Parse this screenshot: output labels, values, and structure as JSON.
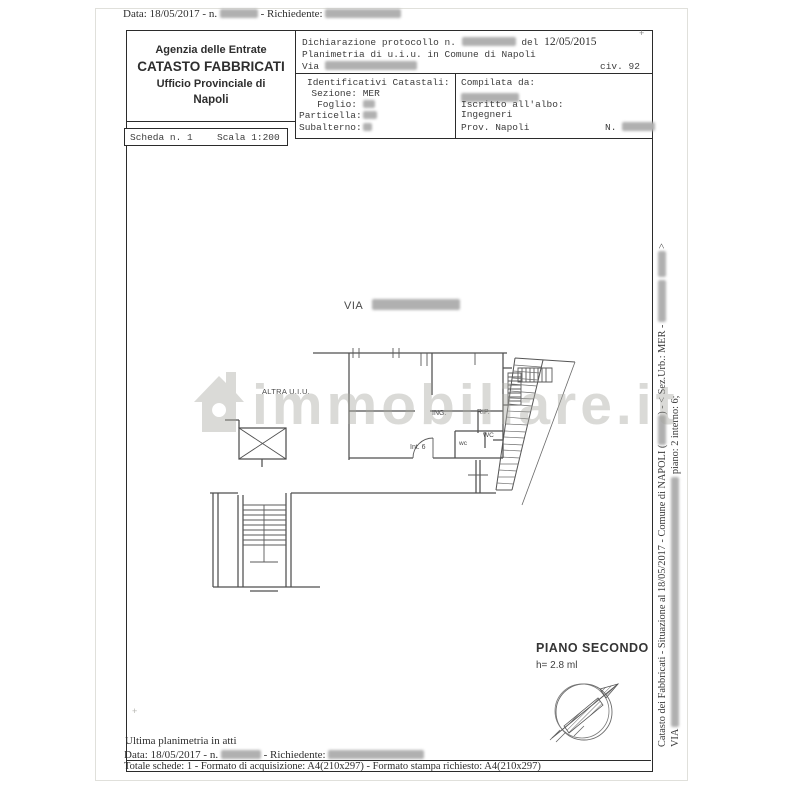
{
  "colors": {
    "ink": "#2b2b2b",
    "typewriter": "#3d3d3d",
    "plan_line": "#4f4f4f",
    "watermark": "rgba(168,168,160,0.42)",
    "redaction": "#b0b0b0"
  },
  "top_bar": {
    "date_prefix": "Data: 18/05/2017 - n.",
    "richiedente_label": "- Richiedente:"
  },
  "agency_box": {
    "line1": "Agenzia delle Entrate",
    "line2": "CATASTO FABBRICATI",
    "line3": "Ufficio Provinciale di",
    "line4": "Napoli"
  },
  "declaration": {
    "protocol_prefix": "Dichiarazione protocollo n.",
    "del_label": "del",
    "date": "12/05/2015",
    "planimetria": "Planimetria di u.i.u. in Comune di Napoli",
    "via_label": "Via",
    "civ": "civ. 92"
  },
  "catasto_ids": {
    "title": "Identificativi Catastali:",
    "rows": [
      {
        "label": "Sezione:",
        "value": "MER"
      },
      {
        "label": "Foglio:",
        "value": ""
      },
      {
        "label": "Particella:",
        "value": ""
      },
      {
        "label": "Subalterno:",
        "value": ""
      }
    ]
  },
  "compiler": {
    "title": "Compilata da:",
    "albo_label": "Iscritto all'albo:",
    "albo_value": "Ingegneri",
    "prov": "Prov. Napoli",
    "n_label": "N."
  },
  "scheda_bar": {
    "scheda": "Scheda n. 1",
    "scala": "Scala 1:200"
  },
  "plan": {
    "via_label": "VIA",
    "altra_uiu": "ALTRA U.I.U.",
    "rooms": {
      "ing": "ING.",
      "rip": "RIP.",
      "wc_upper": "WC",
      "wc_lower": "wc",
      "interno": "Int. 6"
    },
    "piano_label": "PIANO SECONDO",
    "height_label": "h= 2.8 ml"
  },
  "watermark": {
    "text": "immobiliare.it"
  },
  "side_note": {
    "line1_start": "Catasto dei Fabbricati - Situazione al 18/05/2017 - Comune di NAPOLI (",
    "line1_mid": ") - < Sez.Urb.: MER -",
    "line1_end": ">",
    "line2_start": "VIA",
    "line2_end": "piano: 2 interno: 6;"
  },
  "footer": {
    "line1": "Ultima planimetria in atti",
    "line2_prefix": "Data: 18/05/2017 - n.",
    "line2_mid": "- Richiedente:",
    "line3": "Totale schede: 1 - Formato di acquisizione: A4(210x297)  - Formato stampa richiesto: A4(210x297)"
  },
  "marks": {
    "plus": "+"
  }
}
